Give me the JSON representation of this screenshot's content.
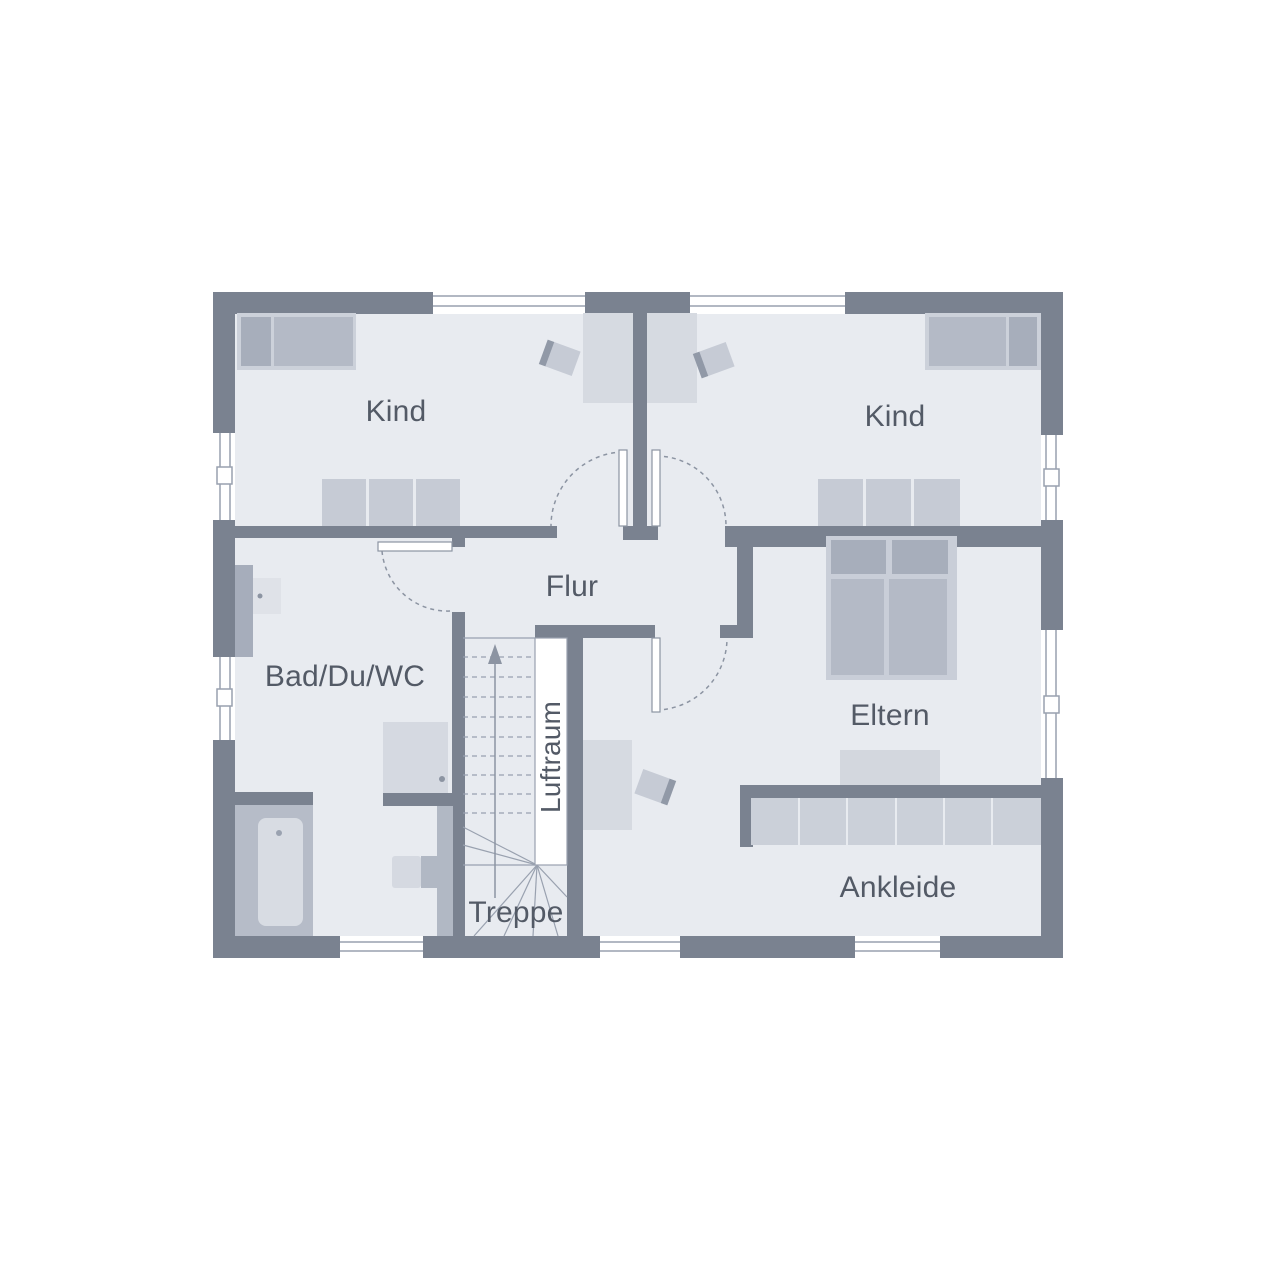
{
  "plan": {
    "type": "floor-plan",
    "language": "de"
  },
  "rooms": {
    "kind_left": {
      "label": "Kind"
    },
    "kind_right": {
      "label": "Kind"
    },
    "flur": {
      "label": "Flur"
    },
    "bad": {
      "label": "Bad/Du/WC"
    },
    "eltern": {
      "label": "Eltern"
    },
    "ankleide": {
      "label": "Ankleide"
    },
    "treppe": {
      "label": "Treppe"
    },
    "luftraum": {
      "label": "Luftraum"
    }
  },
  "colors": {
    "wall": "#7a8290",
    "floor": "#e8ebf0",
    "furniture_dark": "#a7aebb",
    "furniture_mid": "#b4bac6",
    "furniture_light": "#d6dae1",
    "wardrobe": "#c6cbd5",
    "line": "#8c94a2",
    "text": "#535a66",
    "background": "#ffffff"
  }
}
